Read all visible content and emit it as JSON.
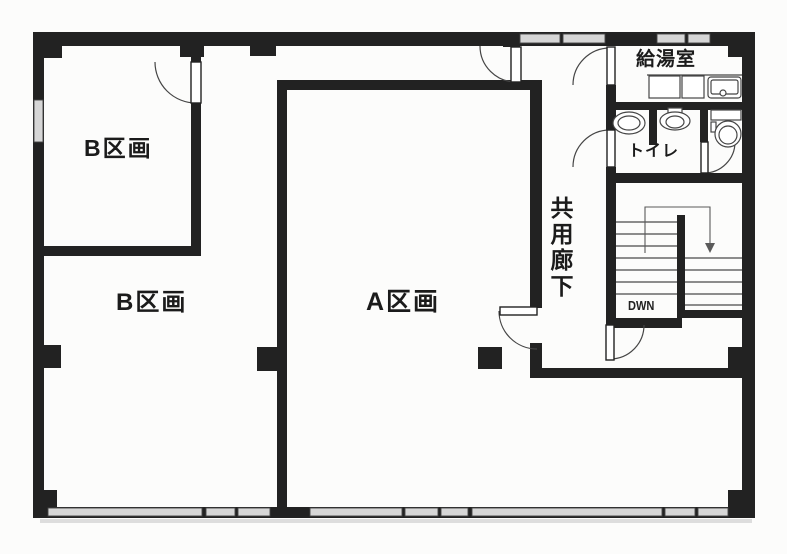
{
  "floor_plan": {
    "labels": {
      "section_b_upper": "B区画",
      "section_b_lower": "B区画",
      "section_a": "A区画",
      "corridor": "共用廊下",
      "kitchenette": "給湯室",
      "toilet": "トイレ",
      "stairs_direction": "DWN"
    },
    "colors": {
      "wall": "#222222",
      "thin_line": "#454545",
      "window_fill": "#d6d6d6",
      "background": "#fcfcfb"
    }
  }
}
